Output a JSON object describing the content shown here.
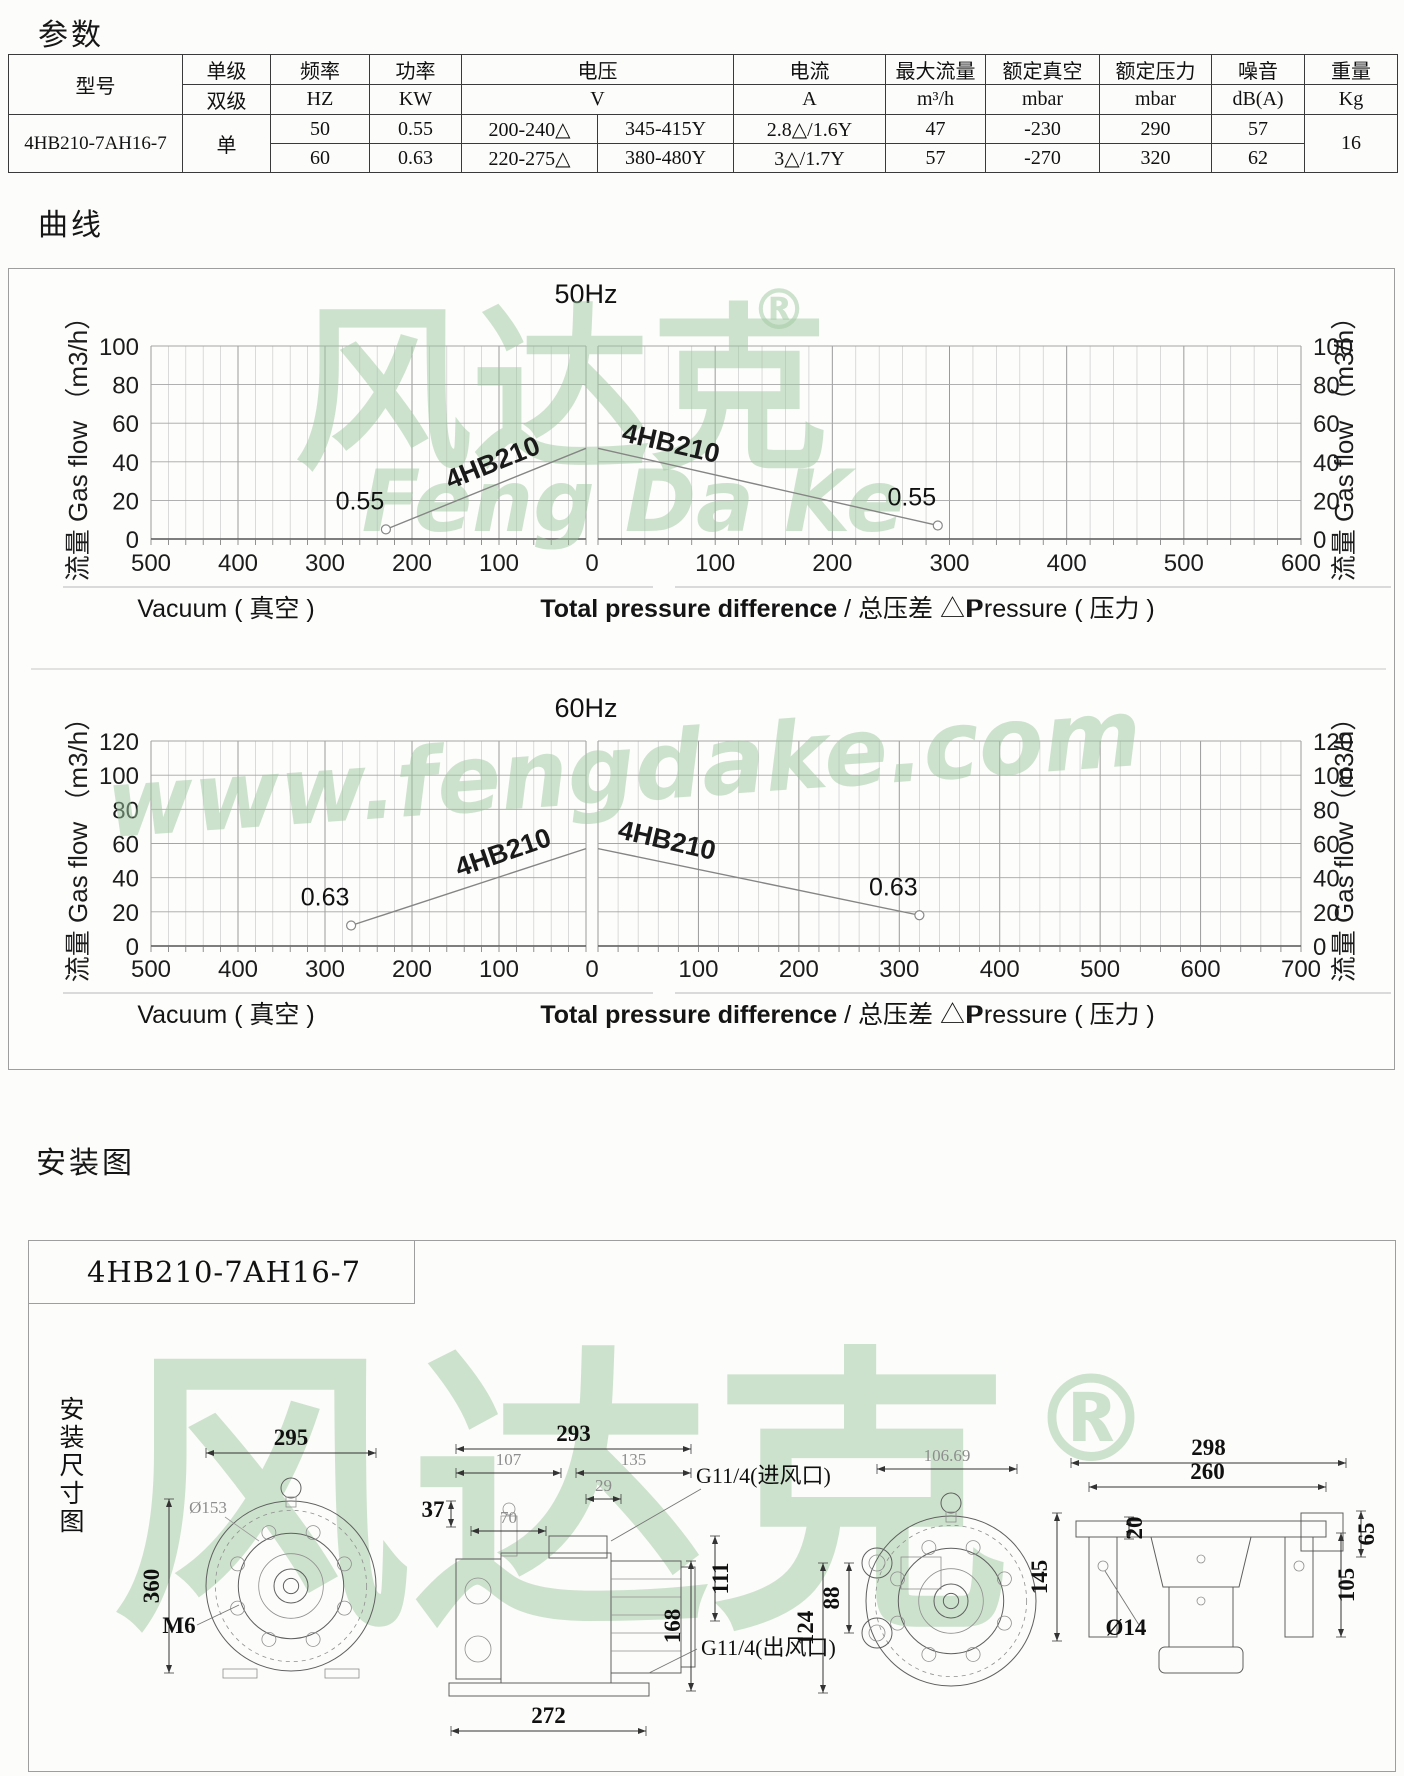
{
  "sections": {
    "params_title": "参数",
    "curves_title": "曲线",
    "install_title": "安装图"
  },
  "params_table": {
    "headers": {
      "model": "型号",
      "stage_top": "单级",
      "stage_bottom": "双级",
      "freq": "频率",
      "freq_unit": "HZ",
      "power": "功率",
      "power_unit": "KW",
      "voltage": "电压",
      "voltage_unit": "V",
      "current": "电流",
      "current_unit": "A",
      "max_flow": "最大流量",
      "max_flow_unit": "m³/h",
      "rated_vacuum": "额定真空",
      "rated_vacuum_unit": "mbar",
      "rated_pressure": "额定压力",
      "rated_pressure_unit": "mbar",
      "noise": "噪音",
      "noise_unit": "dB(A)",
      "weight": "重量",
      "weight_unit": "Kg"
    },
    "model_value": "4HB210-7AH16-7",
    "stage_value": "单",
    "weight_value": "16",
    "rows": [
      {
        "freq": "50",
        "power": "0.55",
        "voltage_delta": "200-240△",
        "voltage_y": "345-415Y",
        "current": "2.8△/1.6Y",
        "max_flow": "47",
        "rated_vacuum": "-230",
        "rated_pressure": "290",
        "noise": "57"
      },
      {
        "freq": "60",
        "power": "0.63",
        "voltage_delta": "220-275△",
        "voltage_y": "380-480Y",
        "current": "3△/1.7Y",
        "max_flow": "57",
        "rated_vacuum": "-270",
        "rated_pressure": "320",
        "noise": "62"
      }
    ]
  },
  "chart_data": [
    {
      "type": "line",
      "title": "50Hz",
      "y_axis": {
        "label": "流量 Gas flow （m3/h）",
        "min": 0,
        "max": 100,
        "step": 20
      },
      "x_left": {
        "caption": "Vacuum ( 真空 )",
        "min": 0,
        "max": 500,
        "step": 100
      },
      "x_right": {
        "caption": "Pressure ( 压力 )",
        "min": 0,
        "max": 600,
        "step": 100
      },
      "x_caption_bold": "Total pressure difference",
      "x_caption_rest": " / 总压差  △P",
      "grid": "on",
      "series": [
        {
          "name": "4HB210",
          "side": "vacuum",
          "points": [
            [
              230,
              5
            ],
            [
              0,
              47
            ]
          ],
          "marker_at": [
            230,
            5
          ],
          "marker_label": "0.55"
        },
        {
          "name": "4HB210",
          "side": "pressure",
          "points": [
            [
              0,
              47
            ],
            [
              290,
              7
            ]
          ],
          "marker_at": [
            290,
            7
          ],
          "marker_label": "0.55"
        }
      ],
      "watermark_lines": [
        "风达克",
        "®",
        "Feng Da Ke"
      ]
    },
    {
      "type": "line",
      "title": "60Hz",
      "y_axis": {
        "label": "流量 Gas flow （m3/h）",
        "min": 0,
        "max": 120,
        "step": 20
      },
      "x_left": {
        "caption": "Vacuum ( 真空 )",
        "min": 0,
        "max": 500,
        "step": 100
      },
      "x_right": {
        "caption": "Pressure ( 压力 )",
        "min": 0,
        "max": 700,
        "step": 100
      },
      "x_caption_bold": "Total pressure difference",
      "x_caption_rest": " / 总压差  △P",
      "grid": "on",
      "series": [
        {
          "name": "4HB210",
          "side": "vacuum",
          "points": [
            [
              270,
              12
            ],
            [
              0,
              57
            ]
          ],
          "marker_at": [
            270,
            12
          ],
          "marker_label": "0.63"
        },
        {
          "name": "4HB210",
          "side": "pressure",
          "points": [
            [
              0,
              57
            ],
            [
              320,
              18
            ]
          ],
          "marker_at": [
            320,
            18
          ],
          "marker_label": "0.63"
        }
      ],
      "watermark_lines": [
        "www.fengdake.com"
      ]
    }
  ],
  "install": {
    "model": "4HB210-7AH16-7",
    "side_label": "安装尺寸图",
    "watermark": [
      "风达克",
      "®"
    ],
    "dims": {
      "front": {
        "width": "295",
        "height": "360",
        "bolt": "M6",
        "circle": "Ø153"
      },
      "side": {
        "width": "293",
        "w107": "107",
        "w135": "135",
        "w29": "29",
        "w70": "70",
        "h37": "37",
        "h111": "111",
        "h168": "168",
        "base": "272",
        "inlet": "G11/4(进风口)",
        "outlet": "G11/4(出风口)"
      },
      "rear": {
        "w106": "106.69",
        "h88": "88",
        "h124": "124"
      },
      "bottom": {
        "w298": "298",
        "w260": "260",
        "h65": "65",
        "h145": "145",
        "h20": "20",
        "h105": "105",
        "hole": "Ø14"
      }
    }
  }
}
